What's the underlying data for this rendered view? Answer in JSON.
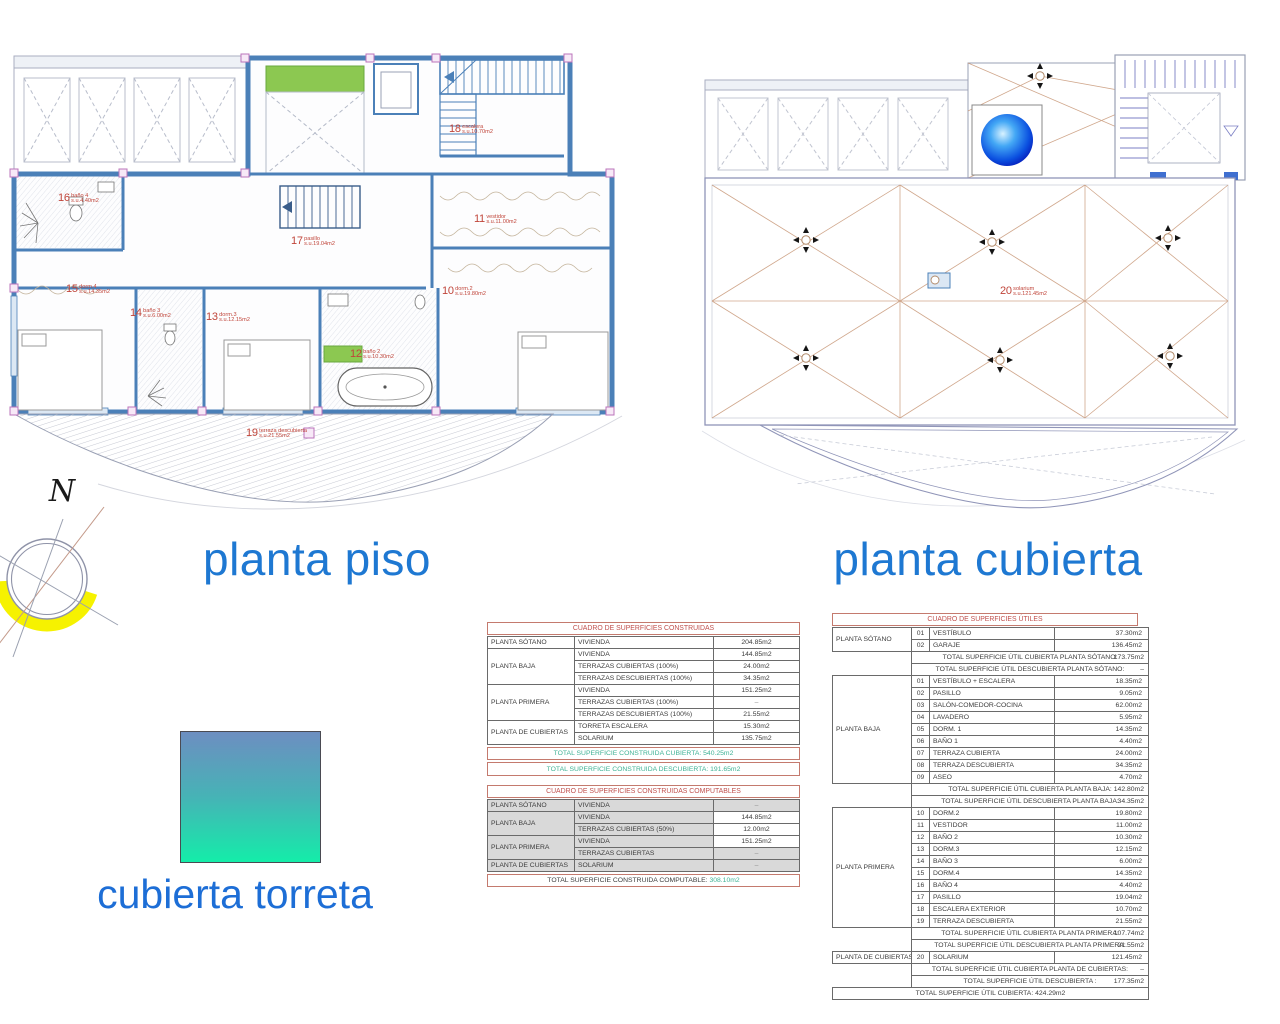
{
  "titles": {
    "plan_left": "planta piso",
    "plan_right": "planta cubierta",
    "legend": "cubierta torreta"
  },
  "compass": {
    "north": "N"
  },
  "colors": {
    "title_blue": "#1e78d2",
    "wall_blue": "#4b80b8",
    "label_red": "#c0453a",
    "value_teal": "#3fb295",
    "table_red": "#c0504d",
    "roof_tan": "#c89878",
    "compass_yellow": "#f6f200",
    "legend_gradient_top": "#6d8ec1",
    "legend_gradient_bottom": "#14eda9"
  },
  "plan_piso": {
    "rooms": [
      {
        "num": "16",
        "name": "baño 4",
        "su": "s.u.4.40m2"
      },
      {
        "num": "15",
        "name": "dorm.4",
        "su": "s.u.14.35m2"
      },
      {
        "num": "14",
        "name": "baño 3",
        "su": "s.u.6.00m2"
      },
      {
        "num": "13",
        "name": "dorm.3",
        "su": "s.u.12.15m2"
      },
      {
        "num": "12",
        "name": "baño 2",
        "su": "s.u.10.30m2"
      },
      {
        "num": "17",
        "name": "pasillo",
        "su": "s.u.19.04m2"
      },
      {
        "num": "11",
        "name": "vestidor",
        "su": "s.u.11.00m2"
      },
      {
        "num": "10",
        "name": "dorm.2",
        "su": "s.u.19.80m2"
      },
      {
        "num": "18",
        "name": "escalera",
        "su": "s.u.10.70m2"
      },
      {
        "num": "19",
        "name": "terraza descubierta",
        "su": "s.u.21.55m2"
      }
    ]
  },
  "plan_cubierta": {
    "rooms": [
      {
        "num": "20",
        "name": "solarium",
        "su": "s.u.121.45m2"
      }
    ]
  },
  "tables": {
    "construidas": {
      "title": "CUADRO DE SUPERFICIES CONSTRUIDAS",
      "rows": [
        {
          "group": "PLANTA SÓTANO",
          "span": 1,
          "concept": "VIVIENDA",
          "value": "204.85m2"
        },
        {
          "group": "PLANTA BAJA",
          "span": 3,
          "concept": "VIVIENDA",
          "value": "144.85m2"
        },
        {
          "concept": "TERRAZAS CUBIERTAS (100%)",
          "value": "24.00m2"
        },
        {
          "concept": "TERRAZAS DESCUBIERTAS (100%)",
          "value": "34.35m2"
        },
        {
          "group": "PLANTA PRIMERA",
          "span": 3,
          "concept": "VIVIENDA",
          "value": "151.25m2"
        },
        {
          "concept": "TERRAZAS CUBIERTAS (100%)",
          "value": "–"
        },
        {
          "concept": "TERRAZAS DESCUBIERTAS (100%)",
          "value": "21.55m2"
        },
        {
          "group": "PLANTA DE CUBIERTAS",
          "span": 2,
          "concept": "TORRETA ESCALERA",
          "value": "15.30m2"
        },
        {
          "concept": "SOLARIUM",
          "value": "135.75m2"
        }
      ],
      "totals": [
        {
          "text": "TOTAL SUPERFICIE CONSTRUIDA CUBIERTA: 540.25m2",
          "teal": true
        },
        {
          "text": "TOTAL SUPERFICIE CONSTRUIDA DESCUBIERTA: 191.65m2",
          "teal": true
        }
      ]
    },
    "computables": {
      "title": "CUADRO DE SUPERFICIES CONSTRUIDAS COMPUTABLES",
      "rows": [
        {
          "group": "PLANTA SÓTANO",
          "span": 1,
          "concept": "VIVIENDA",
          "value": "–"
        },
        {
          "group": "PLANTA BAJA",
          "span": 2,
          "concept": "VIVIENDA",
          "value": "144.85m2"
        },
        {
          "concept": "TERRAZAS CUBIERTAS (50%)",
          "value": "12.00m2"
        },
        {
          "group": "PLANTA PRIMERA",
          "span": 2,
          "concept": "VIVIENDA",
          "value": "151.25m2"
        },
        {
          "concept": "TERRAZAS CUBIERTAS",
          "value": "–"
        },
        {
          "group": "PLANTA DE CUBIERTAS",
          "span": 1,
          "concept": "SOLARIUM",
          "value": "–"
        }
      ],
      "totals": [
        {
          "text": "TOTAL SUPERFICIE CONSTRUIDA COMPUTABLE:",
          "value": "308.10m2",
          "value_teal": true
        }
      ]
    },
    "utiles": {
      "title": "CUADRO DE SUPERFICIES ÚTILES",
      "sections": [
        {
          "group": "PLANTA SÓTANO",
          "rooms": [
            [
              "01",
              "VESTÍBULO",
              "37.30m2"
            ],
            [
              "02",
              "GARAJE",
              "136.45m2"
            ]
          ],
          "totals": [
            {
              "text": "TOTAL SUPERFICIE ÚTIL CUBIERTA PLANTA SÓTANO:",
              "value": "173.75m2"
            },
            {
              "text": "TOTAL SUPERFICIE ÚTIL DESCUBIERTA PLANTA SÓTANO:",
              "value": "–"
            }
          ]
        },
        {
          "group": "PLANTA BAJA",
          "rooms": [
            [
              "01",
              "VESTÍBULO + ESCALERA",
              "18.35m2"
            ],
            [
              "02",
              "PASILLO",
              "9.05m2"
            ],
            [
              "03",
              "SALÓN-COMEDOR-COCINA",
              "62.00m2"
            ],
            [
              "04",
              "LAVADERO",
              "5.95m2"
            ],
            [
              "05",
              "DORM. 1",
              "14.35m2"
            ],
            [
              "06",
              "BAÑO 1",
              "4.40m2"
            ],
            [
              "07",
              "TERRAZA CUBIERTA",
              "24.00m2"
            ],
            [
              "08",
              "TERRAZA DESCUBIERTA",
              "34.35m2"
            ],
            [
              "09",
              "ASEO",
              "4.70m2"
            ]
          ],
          "totals": [
            {
              "text": "TOTAL SUPERFICIE ÚTIL CUBIERTA PLANTA BAJA:",
              "value": "142.80m2"
            },
            {
              "text": "TOTAL SUPERFICIE ÚTIL DESCUBIERTA PLANTA BAJA:",
              "value": "34.35m2"
            }
          ]
        },
        {
          "group": "PLANTA PRIMERA",
          "rooms": [
            [
              "10",
              "DORM.2",
              "19.80m2"
            ],
            [
              "11",
              "VESTIDOR",
              "11.00m2"
            ],
            [
              "12",
              "BAÑO 2",
              "10.30m2"
            ],
            [
              "13",
              "DORM.3",
              "12.15m2"
            ],
            [
              "14",
              "BAÑO 3",
              "6.00m2"
            ],
            [
              "15",
              "DORM.4",
              "14.35m2"
            ],
            [
              "16",
              "BAÑO 4",
              "4.40m2"
            ],
            [
              "17",
              "PASILLO",
              "19.04m2"
            ],
            [
              "18",
              "ESCALERA EXTERIOR",
              "10.70m2"
            ],
            [
              "19",
              "TERRAZA DESCUBIERTA",
              "21.55m2"
            ]
          ],
          "totals": [
            {
              "text": "TOTAL SUPERFICIE ÚTIL CUBIERTA PLANTA PRIMERA:",
              "value": "107.74m2"
            },
            {
              "text": "TOTAL SUPERFICIE ÚTIL DESCUBIERTA PLANTA PRIMERA:",
              "value": "21.55m2"
            }
          ]
        },
        {
          "group": "PLANTA DE CUBIERTAS",
          "rooms": [
            [
              "20",
              "SOLARIUM",
              "121.45m2"
            ]
          ],
          "totals": [
            {
              "text": "TOTAL SUPERFICIE ÚTIL CUBIERTA PLANTA DE CUBIERTAS:",
              "value": "–"
            },
            {
              "text": "TOTAL SUPERFICIE ÚTIL DESCUBIERTA :",
              "value": "177.35m2",
              "teal": true
            }
          ]
        }
      ],
      "grand_total": "TOTAL SUPERFICIE ÚTIL CUBIERTA: 424.29m2"
    }
  }
}
